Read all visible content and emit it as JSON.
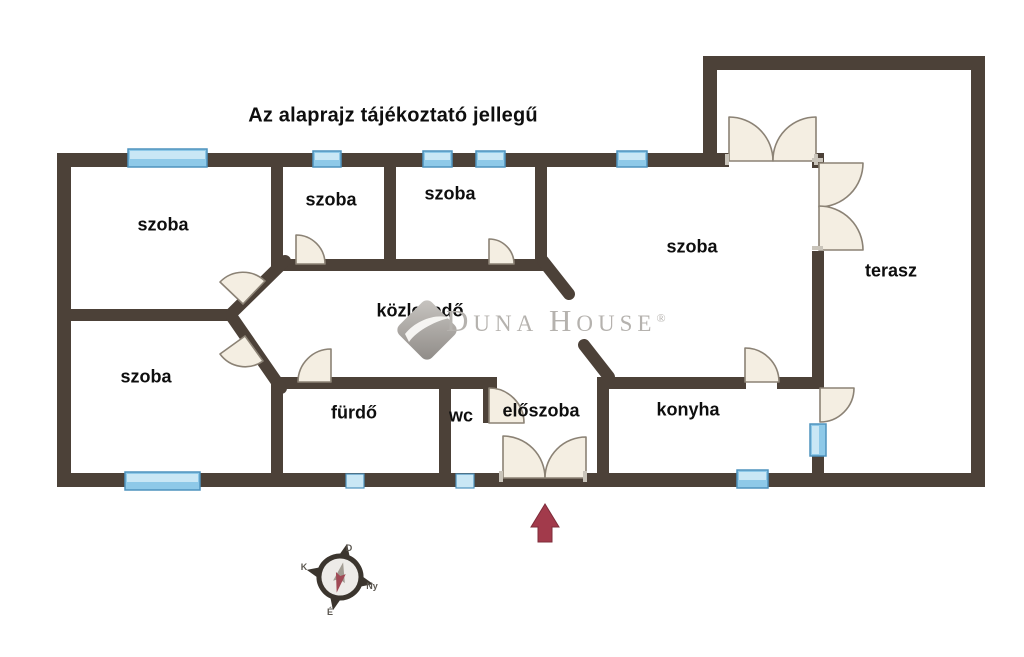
{
  "title": "Az alaprajz tájékoztató jellegű",
  "rooms": {
    "szoba_top_left": "szoba",
    "szoba_top_mid": "szoba",
    "szoba_top_mid2": "szoba",
    "szoba_right": "szoba",
    "terasz": "terasz",
    "szoba_bottom_left": "szoba",
    "kozlekedo": "közlekedő",
    "furdo": "fürdő",
    "wc": "wc",
    "eloszoba": "előszoba",
    "konyha": "konyha"
  },
  "watermark": {
    "d": "D",
    "una": "UNA",
    "h": "H",
    "ouse": "OUSE",
    "registered": "®"
  },
  "compass": {
    "north": "É",
    "south": "D",
    "east": "K",
    "west": "Ny"
  },
  "colors": {
    "wall": "#4c4138",
    "door_fill": "#f4eee2",
    "door_stroke": "#8b8275",
    "window_fill": "#8ec9e8",
    "window_light": "#c9e7f5",
    "window_stroke": "#4e93be",
    "label_text": "#0e0e0e",
    "watermark_gray": "#b5b2ae",
    "arrow_red": "#a23a4b",
    "compass_dark": "#3b352e",
    "background": "#ffffff"
  }
}
